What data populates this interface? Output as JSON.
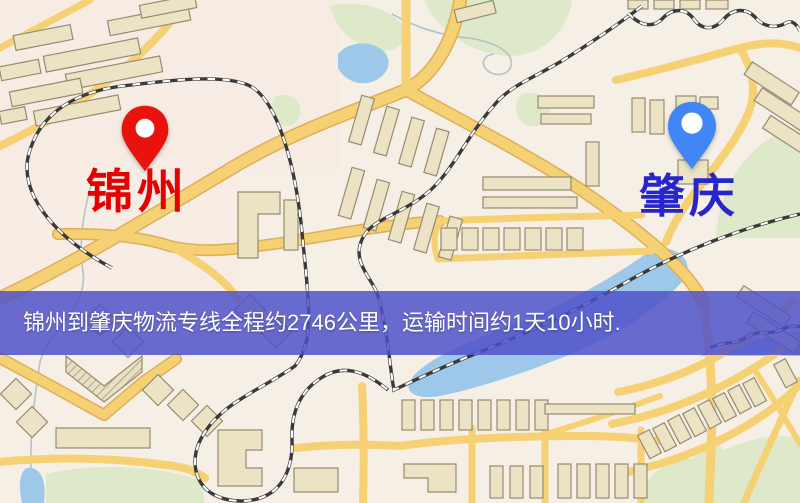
{
  "banner": {
    "text": "锦州到肇庆物流专线全程约2746公里，运输时间约1天10小时.",
    "background": "#4d50c8",
    "text_color": "#ffffff"
  },
  "markers": {
    "origin": {
      "city": "锦州",
      "pin_color": "#e8130c",
      "label_color": "#e60000"
    },
    "destination": {
      "city": "肇庆",
      "pin_color": "#4285f4",
      "label_color": "#2626cc"
    }
  },
  "route": {
    "distance_km": "2746",
    "duration": "1天10小时"
  },
  "map_palette": {
    "background": "#f6efe5",
    "background_tint": "#f8e9e4",
    "road_fill": "#f5d173",
    "road_casing": "#ddae5c",
    "water": "#9ec8ea",
    "park": "#dde9c9",
    "building": "#ece3c4",
    "building_outline": "#968b72",
    "railway": "#3a3a3a"
  }
}
